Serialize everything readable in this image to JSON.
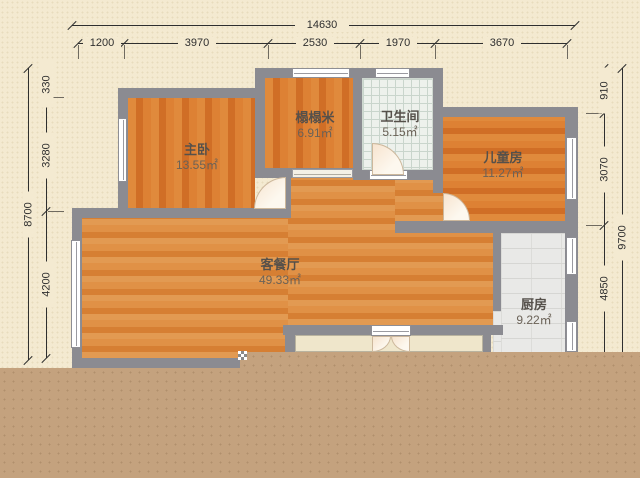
{
  "rooms": [
    {
      "id": "master",
      "name": "主卧",
      "area": "13.55㎡"
    },
    {
      "id": "tatami",
      "name": "榻榻米",
      "area": "6.91㎡"
    },
    {
      "id": "bathroom",
      "name": "卫生间",
      "area": "5.15㎡"
    },
    {
      "id": "children",
      "name": "儿童房",
      "area": "11.27㎡"
    },
    {
      "id": "living",
      "name": "客餐厅",
      "area": "49.33㎡"
    },
    {
      "id": "kitchen",
      "name": "厨房",
      "area": "9.22㎡"
    }
  ],
  "dimensions": {
    "top": {
      "total": "14630",
      "segments": [
        "1200",
        "3970",
        "2530",
        "1970",
        "3670"
      ]
    },
    "left": {
      "total": "8700",
      "segments": [
        "330",
        "3280",
        "4200"
      ]
    },
    "right": {
      "total": "9700",
      "segments": [
        "910",
        "3070",
        "4850"
      ]
    }
  },
  "colors": {
    "bg": "#f4ead1",
    "overlay": "#c4a27e",
    "wall": "#8b8b91",
    "wood_dark": "#d8782c",
    "wood_living": "#dd8c3f",
    "tile_bath": "#edf1ec",
    "tile_line": "#c9d5cc",
    "tile_kitchen": "#e9e9e7",
    "balcony": "#efe6cb",
    "window": "#ffffff",
    "text": "#55504a",
    "dim": "#2f2f2f"
  }
}
